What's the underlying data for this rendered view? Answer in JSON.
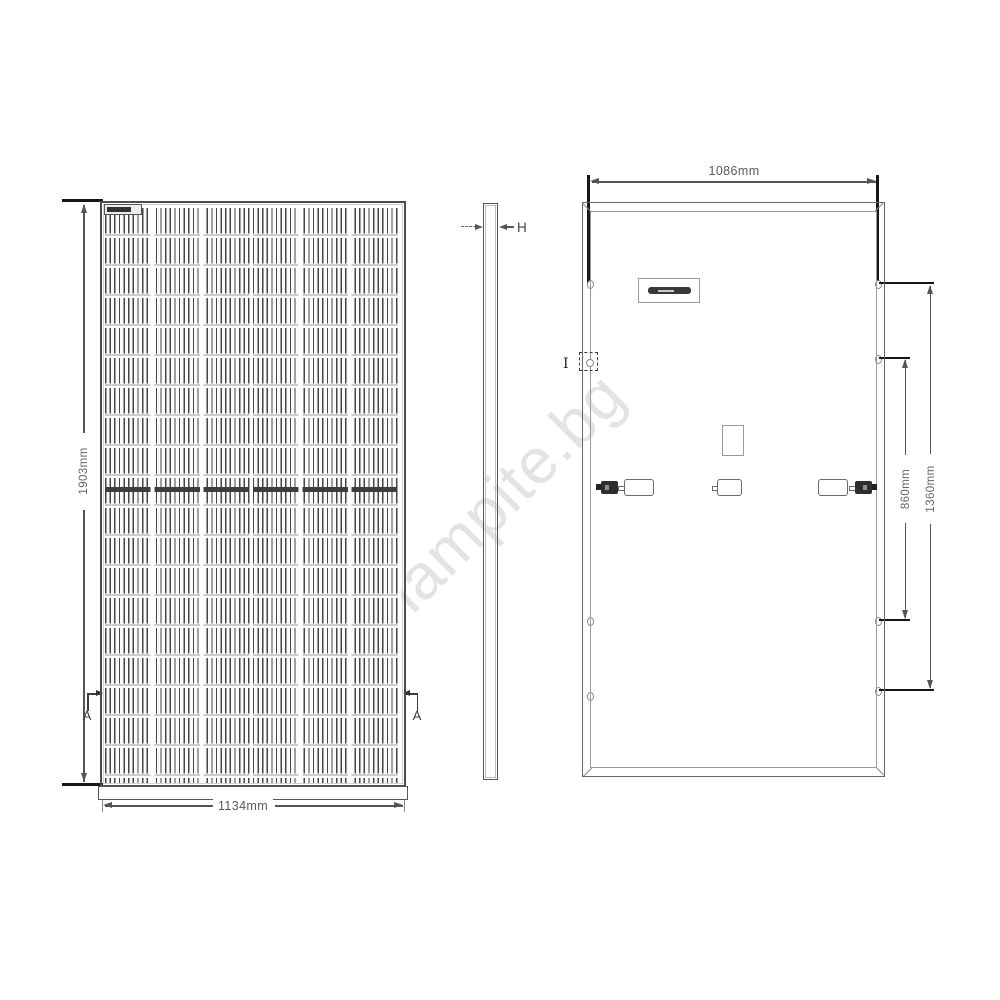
{
  "watermark": {
    "text": "lampite.bg",
    "color": "#e3e3e3"
  },
  "front_view": {
    "height_dimension": "1903mm",
    "width_dimension": "1134mm",
    "section_label_left": "A",
    "section_label_right": "A"
  },
  "side_view": {
    "thickness_dimension": "H"
  },
  "back_view": {
    "top_width_dimension": "1086mm",
    "inner_mounting_dimension": "860mm",
    "outer_mounting_dimension": "1360mm",
    "grounding_hole_label": "I"
  },
  "colors": {
    "line": "#555555",
    "dark_fill": "#323232",
    "watermark": "#e3e3e3"
  }
}
